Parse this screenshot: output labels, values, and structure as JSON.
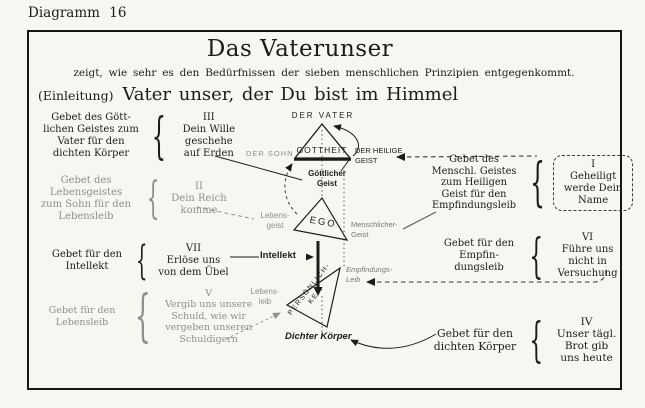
{
  "page": {
    "diagram_label": "Diagramm 16"
  },
  "header": {
    "title": "Das Vaterunser",
    "subtitle": "zeigt, wie sehr es den Bedürfnissen der sieben menschlichen Prinzipien entgegenkommt.",
    "intro_prefix": "(Einleitung)",
    "intro_text": "Vater unser, der Du bist im Himmel"
  },
  "trinity": {
    "father": "DER VATER",
    "son": "DER SOHN",
    "holy_spirit": [
      "DER HEILIGE",
      "GEIST"
    ],
    "godhead": "GOTTHEIT"
  },
  "principles": {
    "goettlicher_geist": [
      "Göttlicher",
      "Geist"
    ],
    "lebensgeist": [
      "Lebens-",
      "geist"
    ],
    "menschlicher_geist": [
      "Menschlicher-",
      "Geist"
    ],
    "ego": "EGO",
    "intellekt": "Intellekt",
    "empfindungsleib": [
      "Empfindungs-",
      "Leib"
    ],
    "lebensleib": [
      "Lebens-",
      "leib"
    ],
    "persoenlichkeit": [
      "PERSÖNLICH-",
      "KEIT"
    ],
    "dichter_koerper": "Dichter Körper"
  },
  "left_blocks": [
    {
      "id": "III",
      "label": [
        "Gebet des Gött-",
        "lichen Geistes zum",
        "Vater für den",
        "dichten Körper"
      ],
      "prayer": [
        "III",
        "Dein Wille",
        "geschehe",
        "auf Erden"
      ]
    },
    {
      "id": "II",
      "label": [
        "Gebet des",
        "Lebensgeistes",
        "zum Sohn für den",
        "Lebensleib"
      ],
      "prayer": [
        "II",
        "Dein Reich",
        "komme"
      ]
    },
    {
      "id": "VII",
      "label": [
        "Gebet für den",
        "Intellekt"
      ],
      "prayer": [
        "VII",
        "Erlöse uns",
        "von dem Übel"
      ]
    },
    {
      "id": "V",
      "label": [
        "Gebet für den",
        "Lebensleib"
      ],
      "prayer": [
        "V",
        "Vergib uns unsere",
        "Schuld, wie wir",
        "vergeben unseren",
        "Schuldigern"
      ]
    }
  ],
  "right_blocks": [
    {
      "id": "I",
      "label": [
        "Gebet des",
        "Menschl. Geistes",
        "zum Heiligen",
        "Geist für den",
        "Empfindungsleib"
      ],
      "prayer": [
        "I",
        "Geheiligt",
        "werde Dein",
        "Name"
      ]
    },
    {
      "id": "VI",
      "label": [
        "Gebet für den",
        "Empfin-",
        "dungsleib"
      ],
      "prayer": [
        "VI",
        "Führe uns",
        "nicht in",
        "Versuchung"
      ]
    },
    {
      "id": "IV",
      "label": [
        "Gebet für den",
        "dichten Körper"
      ],
      "prayer": [
        "IV",
        "Unser tägl.",
        "Brot gib",
        "uns heute"
      ]
    }
  ],
  "colors": {
    "ink": "#1e1c1a",
    "faded": "#8f8f8f",
    "paper": "#f7f6f1"
  }
}
